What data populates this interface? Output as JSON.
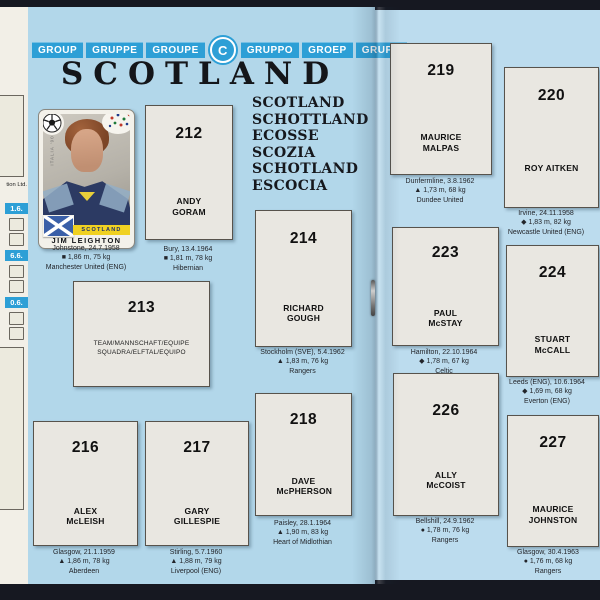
{
  "header": {
    "group_words": [
      "GROUP",
      "GRUPPE",
      "GROUPE",
      "GRUPPO",
      "GROEP",
      "GRUPO"
    ],
    "group_letter": "C",
    "title": "SCOTLAND",
    "country_names": [
      "SCOTLAND",
      "SCHOTTLAND",
      "ECOSSE",
      "SCOZIA",
      "SCHOTLAND",
      "ESCOCIA"
    ]
  },
  "edge": {
    "partial_text": "tion Ltd.",
    "dates": [
      "1.6.",
      "6.6.",
      "0.6."
    ]
  },
  "filled_sticker": {
    "player": "JIM LEIGHTON",
    "banner": "SCOTLAND",
    "edge_text": "ITALIA '90",
    "caption1": "Johnstone, 24.7.1958",
    "caption2": "■  1,86 m, 75 kg",
    "caption3": "Manchester United (ENG)"
  },
  "team_slot": {
    "number": "213",
    "line1": "TEAM/MANNSCHAFT/EQUIPE",
    "line2": "SQUADRA/ELFTAL/EQUIPO"
  },
  "slots": [
    {
      "number": "212",
      "name": "ANDY GORAM",
      "caption1": "Bury, 13.4.1964",
      "caption2": "■  1,81 m, 78 kg",
      "caption3": "Hibernian"
    },
    {
      "number": "214",
      "name": "RICHARD GOUGH",
      "caption1": "Stockholm (SVE), 5.4.1962",
      "caption2": "▲  1,83 m, 76 kg",
      "caption3": "Rangers"
    },
    {
      "number": "216",
      "name": "ALEX McLEISH",
      "caption1": "Glasgow, 21.1.1959",
      "caption2": "▲  1,86 m, 78 kg",
      "caption3": "Aberdeen"
    },
    {
      "number": "217",
      "name": "GARY GILLESPIE",
      "caption1": "Stirling, 5.7.1960",
      "caption2": "▲  1,88 m, 79 kg",
      "caption3": "Liverpool (ENG)"
    },
    {
      "number": "218",
      "name": "DAVE McPHERSON",
      "caption1": "Paisley, 28.1.1964",
      "caption2": "▲  1,90 m, 83 kg",
      "caption3": "Heart of Midlothian"
    },
    {
      "number": "219",
      "name": "MAURICE MALPAS",
      "caption1": "Dunfermline, 3.8.1962",
      "caption2": "▲  1,73 m, 68 kg",
      "caption3": "Dundee United"
    },
    {
      "number": "220",
      "name": "ROY AITKEN",
      "caption1": "Irvine, 24.11.1958",
      "caption2": "◆  1,83 m, 82 kg",
      "caption3": "Newcastle United (ENG)"
    },
    {
      "number": "223",
      "name": "PAUL McSTAY",
      "caption1": "Hamilton, 22.10.1964",
      "caption2": "◆  1,78 m, 67 kg",
      "caption3": "Celtic"
    },
    {
      "number": "224",
      "name": "STUART McCALL",
      "caption1": "Leeds (ENG), 10.6.1964",
      "caption2": "◆  1,69 m, 68 kg",
      "caption3": "Everton (ENG)"
    },
    {
      "number": "226",
      "name": "ALLY McCOIST",
      "caption1": "Bellshill, 24.9.1962",
      "caption2": "●  1,78 m, 76 kg",
      "caption3": "Rangers"
    },
    {
      "number": "227",
      "name": "MAURICE JOHNSTON",
      "caption1": "Glasgow, 30.4.1963",
      "caption2": "●  1,76 m, 68 kg",
      "caption3": "Rangers"
    }
  ],
  "colors": {
    "page_blue": "#b2d7ea",
    "banner_blue": "#2d9fd6",
    "slot_fill": "#e9e7e1",
    "flag_blue": "#3a5fa8",
    "banner_yellow": "#f0d122",
    "background": "#161821"
  }
}
